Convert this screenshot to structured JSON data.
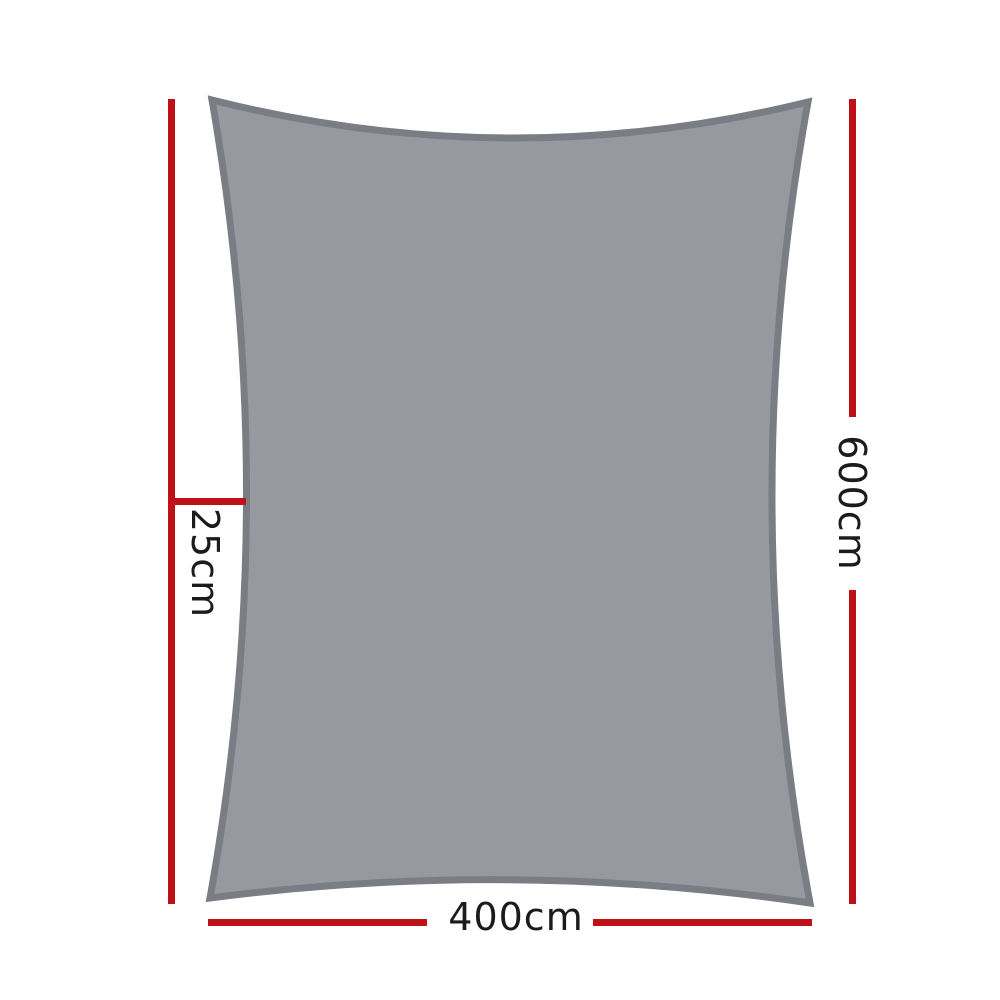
{
  "dimensions": {
    "height": {
      "label": "600cm",
      "side": "right"
    },
    "width": {
      "label": "400cm",
      "side": "bottom"
    },
    "edge_curve_depth": {
      "label": "25cm",
      "side": "left"
    }
  },
  "colors": {
    "background": "#ffffff",
    "dimension-line": "#c11118",
    "label-text": "#1b1b1b",
    "sail-fill": "#97999f",
    "sail-border": "#7b7d85"
  }
}
